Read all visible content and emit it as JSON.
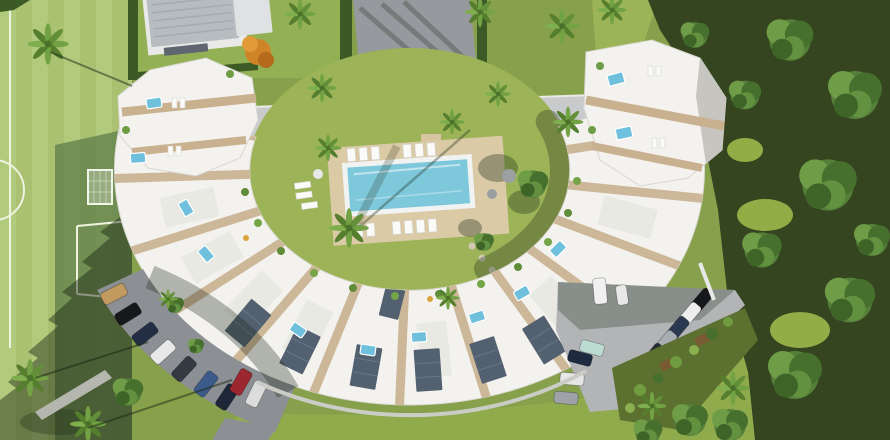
{
  "scene": {
    "name": "aerial-3d-render-residential-complex",
    "description": "Bird's-eye architectural rendering: crescent-shaped row of white townhouses with rooftop terraces and plunge pools around a central lawn courtyard with a long rectangular swimming pool; detached villa with grey roof and driveway at top; soccer field on the left; dense forest on the right; curved parking lots with cars at bottom left, bottom right and along the top access road."
  },
  "colors": {
    "grass": "#87a04b",
    "bottom_lawn": "#90ab4c",
    "field": "#b2ca7c",
    "field_stripe": "#a9c171",
    "field_shade": "#5c7b47",
    "line_white": "#edf3de",
    "forest": "#34451f",
    "hedge": "#3c5a26",
    "building": "#f3f2ee",
    "walkway_tan": "#c9b18f",
    "villa_roof": "#b7bcc1",
    "villa_wall": "#e9e9e7",
    "driveway": "#96999d",
    "road": "#c9cacc",
    "courtyard_lawn": "#9cb457",
    "pool_deck": "#dbcaa6",
    "pool_rim": "#f0f3f2",
    "pool_water": "#7ec8dc",
    "roof_pool": "#6fc0dc",
    "solar_panel": "#526070",
    "parking_left": "#8c9094",
    "parking_right": "#b2b4b6",
    "wall": "#cbccc5",
    "orange_tree": "#d08428"
  },
  "road": {
    "car_colors": [
      "#ededed",
      "#ededed",
      "#17181c",
      "#f0f0f0",
      "#ededed",
      "#1a1b20",
      "#ededed"
    ]
  },
  "parking_bottom_left": {
    "car_colors": [
      "#c19a5f",
      "#17181c",
      "#232e44",
      "#e8e8e8",
      "#343a42",
      "#3c5a8a",
      "#1d2738",
      "#9c2730",
      "#dcdcdc"
    ]
  },
  "parking_bottom_right": {
    "right_row_colors": [
      "#16181c",
      "#eeeeee",
      "#2a3850",
      "#a8adb2",
      "#262c34",
      "#a8262f"
    ],
    "left_group_colors": [
      "#f0f0f0",
      "#e8e8e8",
      "#bcdcd2",
      "#1e2a40",
      "#e6e6e6",
      "#9fa3a7"
    ]
  },
  "counts": {
    "road_cars": 7,
    "parking_bottom_left_cars": 9,
    "parking_bottom_right_cars": 12,
    "rooftop_pools": 12,
    "poolside_loungers": 12,
    "palm_trees": 17,
    "shade_trees": 15
  }
}
